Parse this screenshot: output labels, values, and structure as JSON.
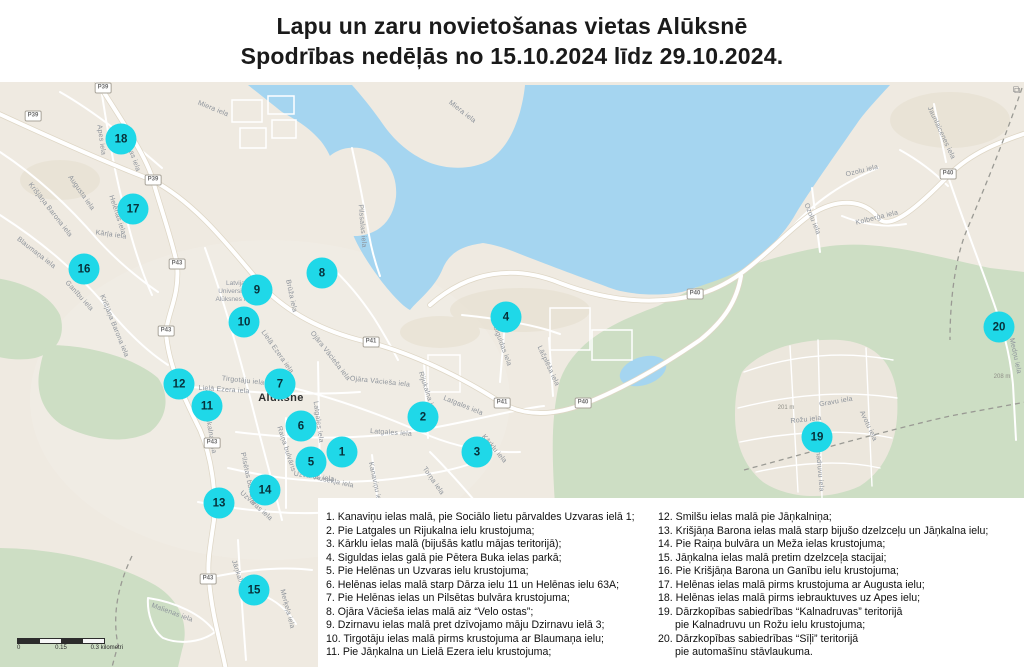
{
  "title": {
    "line1": "Lapu un zaru novietošanas vietas Alūksnē",
    "line2": "Spodrības nedēļās no 15.10.2024 līdz 29.10.2024."
  },
  "map": {
    "town_label": "Alūksne",
    "poi_lines": [
      "Latvijas",
      "Universitātes",
      "Alūksnes filiāle"
    ],
    "expand_glyph": "⧉",
    "markers": [
      "1",
      "2",
      "3",
      "4",
      "5",
      "6",
      "7",
      "8",
      "9",
      "10",
      "11",
      "12",
      "13",
      "14",
      "15",
      "16",
      "17",
      "18",
      "19",
      "20"
    ],
    "street_labels": [
      "Miera iela",
      "Miera iela",
      "Apes iela",
      "Helēnas iela",
      "Kārļa iela",
      "Augusta iela",
      "Krišjāņa Barona iela",
      "Blaumaņa iela",
      "Ganību iela",
      "Krišjāņa Barona iela",
      "Brūža iela",
      "Ojāra Vācieša iela",
      "Ojāra Vācieša iela",
      "Lielā Ezera iela",
      "Lielā Ezera iela",
      "Latgales iela",
      "Latgales iela",
      "Latgales iela",
      "Rijukalna iela",
      "Siguldas iela",
      "Lāčplēša iela",
      "Raiņa bulvāris",
      "Uzvaras iela",
      "Uzvaras iela",
      "Ausekļa iela",
      "Kanaviņu iela",
      "Torņa iela",
      "Kārklu iela",
      "Pilssalas iela",
      "Ozolu iela",
      "Ozolu iela",
      "Kolberģa iela",
      "Jaunlaicenes iela",
      "Gravu iela",
      "Rožu iela",
      "Avotu iela",
      "Kalnadruvu iela",
      "Jāņkalna iela",
      "Malienas iela",
      "Merķeļa iela",
      "Jāņkalna iela",
      "Pilsētas bulvāris",
      "Tirgotāju iela",
      "Medņu iela",
      "Helēnas iela"
    ],
    "road_badges": [
      "P39",
      "P39",
      "P39",
      "P43",
      "P43",
      "P43",
      "P43",
      "P41",
      "P41",
      "P40",
      "P40",
      "P40"
    ],
    "elevation": [
      "201 m",
      "208 m"
    ],
    "scale": {
      "start": "0",
      "mid": "0.15",
      "end": "0.3 kilometri"
    }
  },
  "legend": {
    "col1": [
      "1. Kanaviņu ielas malā, pie Sociālo lietu pārvaldes Uzvaras ielā 1;",
      "2. Pie Latgales un Rijukalna ielu krustojuma;",
      "3. Kārklu ielas malā (bijušās katlu mājas teritorijā);",
      "4. Siguldas ielas galā pie Pētera Buka ielas parkā;",
      "5. Pie Helēnas un Uzvaras ielu krustojuma;",
      "6. Helēnas ielas malā starp Dārza ielu 11 un Helēnas ielu 63A;",
      "7. Pie Helēnas ielas un Pilsētas bulvāra krustojuma;",
      "8. Ojāra Vācieša ielas malā aiz “Velo ostas”;",
      "9. Dzirnavu ielas malā pret dzīvojamo māju Dzirnavu ielā 3;",
      "10. Tirgotāju ielas malā pirms krustojuma ar Blaumaņa ielu;",
      "11. Pie Jāņkalna un Lielā Ezera ielu krustojuma;"
    ],
    "col2": [
      "12. Smilšu ielas malā pie Jāņkalniņa;",
      "13. Krišjāņa Barona ielas malā starp bijušo dzelzceļu un Jāņkalna ielu;",
      "14. Pie Raiņa bulvāra un Meža ielas krustojuma;",
      "15. Jāņkalna ielas malā pretim dzelzceļa stacijai;",
      "16. Pie Krišjāņa Barona un Ganību ielu krustojuma;",
      "17. Helēnas ielas malā pirms krustojuma ar Augusta ielu;",
      "18. Helēnas ielas malā pirms iebrauktuves uz Apes ielu;",
      "19. Dārzkopības sabiedrības “Kalnadruvas” teritorijā",
      "pie Kalnadruvu un Rožu ielu krustojuma;",
      "20. Dārzkopības sabiedrības “Sīļi” teritorijā",
      "pie automašīnu stāvlaukuma."
    ]
  }
}
